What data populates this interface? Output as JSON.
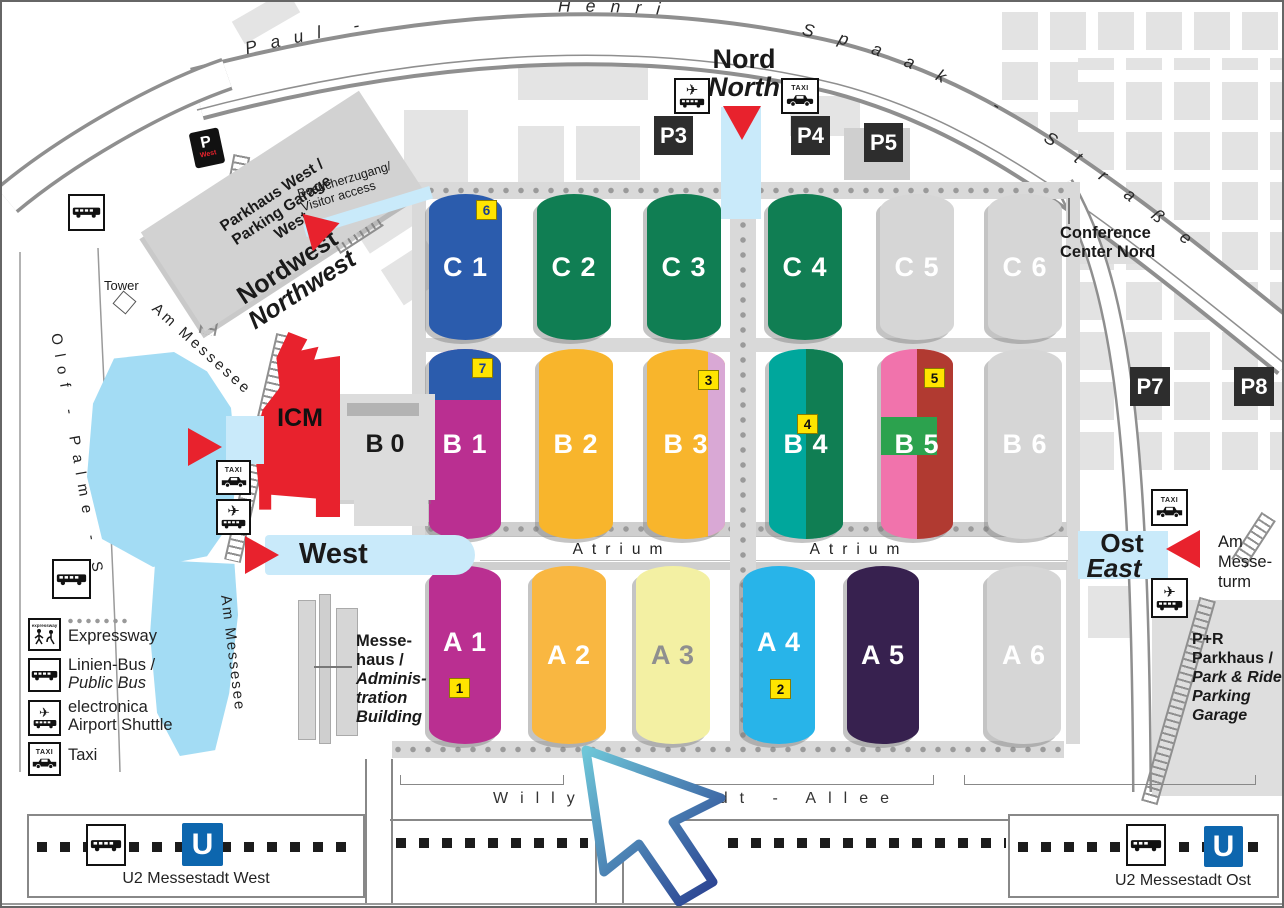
{
  "streets": {
    "paul": "Paul -",
    "henri": "Henri",
    "spaak": "Spaak - Straße",
    "willy_brandt_allee": "Willy - Brandt - Allee",
    "olof_palme": "Olof - Palme - S",
    "am_messesee": "Am Messesee",
    "am_messeturm_lines": [
      "Am",
      "Messe-",
      "turm"
    ]
  },
  "entrances": {
    "nord": {
      "de": "Nord",
      "en": "North"
    },
    "nordwest": {
      "de": "Nordwest",
      "en": "Northwest"
    },
    "west": {
      "de": "West"
    },
    "ost": {
      "de": "Ost",
      "en": "East"
    }
  },
  "buildings": {
    "icm": "ICM",
    "b0": "B 0",
    "tower": "Tower",
    "parkhaus_west_lines": [
      "Parkhaus West /",
      "Parking Garage",
      "West"
    ],
    "visitor_access_lines": [
      "Besucherzugang/",
      "Visitor access"
    ],
    "conference_lines": [
      "Conference",
      "Center Nord"
    ],
    "messehaus_lines": [
      "Messe-",
      "haus /",
      "Adminis-",
      "tration",
      "Building"
    ],
    "pr_lines": [
      "P+R",
      "Parkhaus /",
      "Park & Ride",
      "Parking",
      "Garage"
    ]
  },
  "parking": {
    "p3": "P3",
    "p4": "P4",
    "p5": "P5",
    "p7": "P7",
    "p8": "P8"
  },
  "halls": {
    "C1": {
      "label": "C 1",
      "color": "#2b5cad",
      "text": "#ffffff",
      "badge": "6",
      "badge_text": "#1c3f8f"
    },
    "C2": {
      "label": "C 2",
      "color": "#107e53",
      "text": "#ffffff"
    },
    "C3": {
      "label": "C 3",
      "color": "#107e53",
      "text": "#ffffff"
    },
    "C4": {
      "label": "C 4",
      "color": "#107e53",
      "text": "#ffffff"
    },
    "C5": {
      "label": "C 5",
      "color": "#d6d6d6",
      "text": "#ffffff"
    },
    "C6": {
      "label": "C 6",
      "color": "#d6d6d6",
      "text": "#ffffff"
    },
    "B1": {
      "label": "B 1",
      "color": "#ba2f91",
      "top_color": "#2b5cad",
      "text": "#ffffff",
      "badge": "7",
      "badge_text": "#1c3f8f"
    },
    "B2": {
      "label": "B 2",
      "color": "#f8b52c",
      "text": "#ffffff"
    },
    "B3": {
      "label": "B 3",
      "color": "#f8b52c",
      "stripe_color": "#d9a8d5",
      "text": "#ffffff",
      "badge": "3",
      "badge_text": "#111111"
    },
    "B4": {
      "label": "B 4",
      "color": "#00a79c",
      "right_color": "#107e53",
      "text": "#ffffff",
      "badge": "4",
      "badge_text": "#111111"
    },
    "B5": {
      "label": "B 5",
      "color": "#f173ac",
      "right_color": "#b13a31",
      "patch_color": "#2ca24e",
      "text": "#ffffff",
      "badge": "5",
      "badge_text": "#111111"
    },
    "B6": {
      "label": "B 6",
      "color": "#d6d6d6",
      "text": "#ffffff"
    },
    "A1": {
      "label": "A 1",
      "color": "#ba2f91",
      "text": "#ffffff",
      "badge": "1",
      "badge_text": "#111111"
    },
    "A2": {
      "label": "A 2",
      "color": "#f9b741",
      "text": "#ffffff"
    },
    "A3": {
      "label": "A 3",
      "color": "#f3f0a3",
      "text": "#8f8f8f"
    },
    "A4": {
      "label": "A 4",
      "color": "#28b4e9",
      "text": "#ffffff",
      "badge": "2",
      "badge_text": "#111111"
    },
    "A5": {
      "label": "A 5",
      "color": "#37214f",
      "text": "#ffffff"
    },
    "A6": {
      "label": "A 6",
      "color": "#d6d6d6",
      "text": "#ffffff"
    }
  },
  "labels": {
    "atrium": "Atrium"
  },
  "legend": {
    "items": [
      {
        "icon": "expressway-icon",
        "lines": [
          "Expressway"
        ]
      },
      {
        "icon": "public-bus-icon",
        "lines": [
          "Linien-Bus /",
          "Public Bus"
        ]
      },
      {
        "icon": "airport-shuttle-icon",
        "lines": [
          "electronica",
          "Airport Shuttle"
        ]
      },
      {
        "icon": "taxi-icon",
        "lines": [
          "Taxi"
        ]
      }
    ]
  },
  "transit": {
    "u_logo": "U",
    "west_station": "U2 Messestadt West",
    "ost_station": "U2 Messestadt Ost"
  },
  "icons": {
    "taxi_text": "TAXI",
    "expressway_text": "expressway",
    "p_west": {
      "p": "P",
      "west": "West"
    }
  },
  "colors": {
    "entrance_red": "#e8222d",
    "walkway_blue": "#c9eafa",
    "ubahn_blue": "#0d66ae",
    "lake_blue": "#a3dcf4",
    "badge_yellow": "#ffe400"
  }
}
